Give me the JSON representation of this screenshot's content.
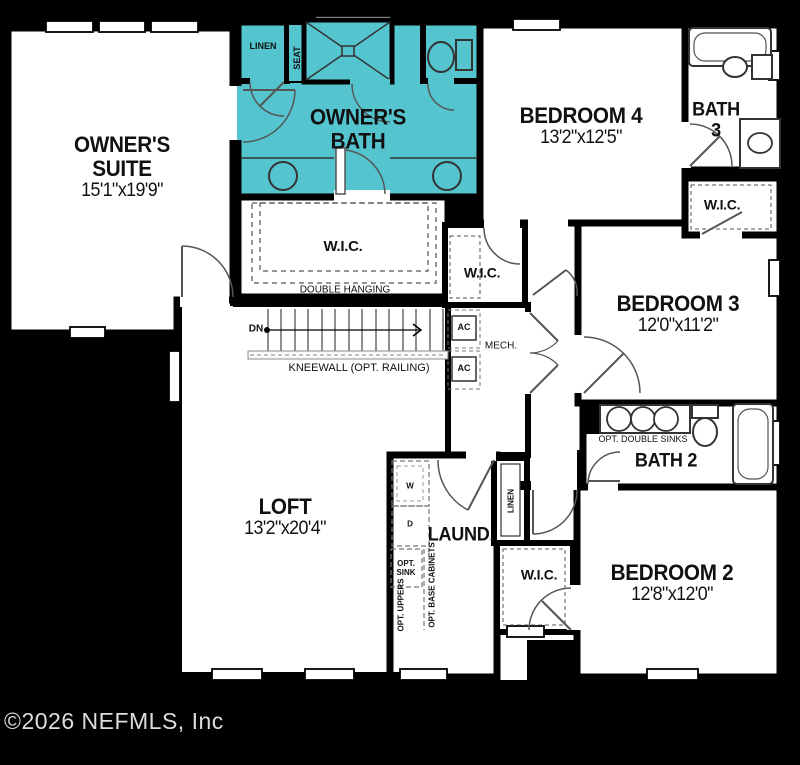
{
  "canvas": {
    "width": 800,
    "height": 765,
    "background": "#000000"
  },
  "palette": {
    "room_fill": "#ffffff",
    "wall": "#000000",
    "highlight_fill": "#54c5ce",
    "door_swing": "#555555",
    "footer_text": "#dddddd"
  },
  "footer": {
    "copyright": "©2026 NEFMLS, Inc"
  },
  "rooms": {
    "owners_suite": {
      "line1": "OWNER'S",
      "line2": "SUITE",
      "dims": "15'1\"x19'9\""
    },
    "owners_bath": {
      "line1": "OWNER'S",
      "line2": "BATH"
    },
    "bedroom4": {
      "name": "BEDROOM 4",
      "dims": "13'2\"x12'5\""
    },
    "bath3": {
      "line1": "BATH",
      "line2": "3"
    },
    "bedroom3": {
      "name": "BEDROOM 3",
      "dims": "12'0\"x11'2\""
    },
    "bath2": {
      "name": "BATH 2"
    },
    "bedroom2": {
      "name": "BEDROOM 2",
      "dims": "12'8\"x12'0\""
    },
    "loft": {
      "name": "LOFT",
      "dims": "13'2\"x20'4\""
    },
    "laundry": {
      "name": "LAUND."
    }
  },
  "closets": {
    "wic_owners": "W.I.C.",
    "wic_hall": "W.I.C.",
    "wic_bedroom3": "W.I.C.",
    "wic_bedroom2": "W.I.C.",
    "linen_bath": "LINEN",
    "linen_hall": "LINEN",
    "double_hanging": "DOUBLE HANGING"
  },
  "stairs": {
    "down": "DN",
    "kneewall": "KNEEWALL (OPT. RAILING)"
  },
  "mechanical": {
    "mech": "MECH.",
    "ac1": "AC",
    "ac2": "AC"
  },
  "fixtures": {
    "seat": "SEAT",
    "opt_double_sinks": "OPT. DOUBLE SINKS",
    "washer": "W",
    "dryer": "D",
    "opt_sink_line1": "OPT.",
    "opt_sink_line2": "SINK",
    "opt_uppers": "OPT. UPPERS",
    "opt_base_cabinets": "OPT. BASE CABINETS"
  }
}
